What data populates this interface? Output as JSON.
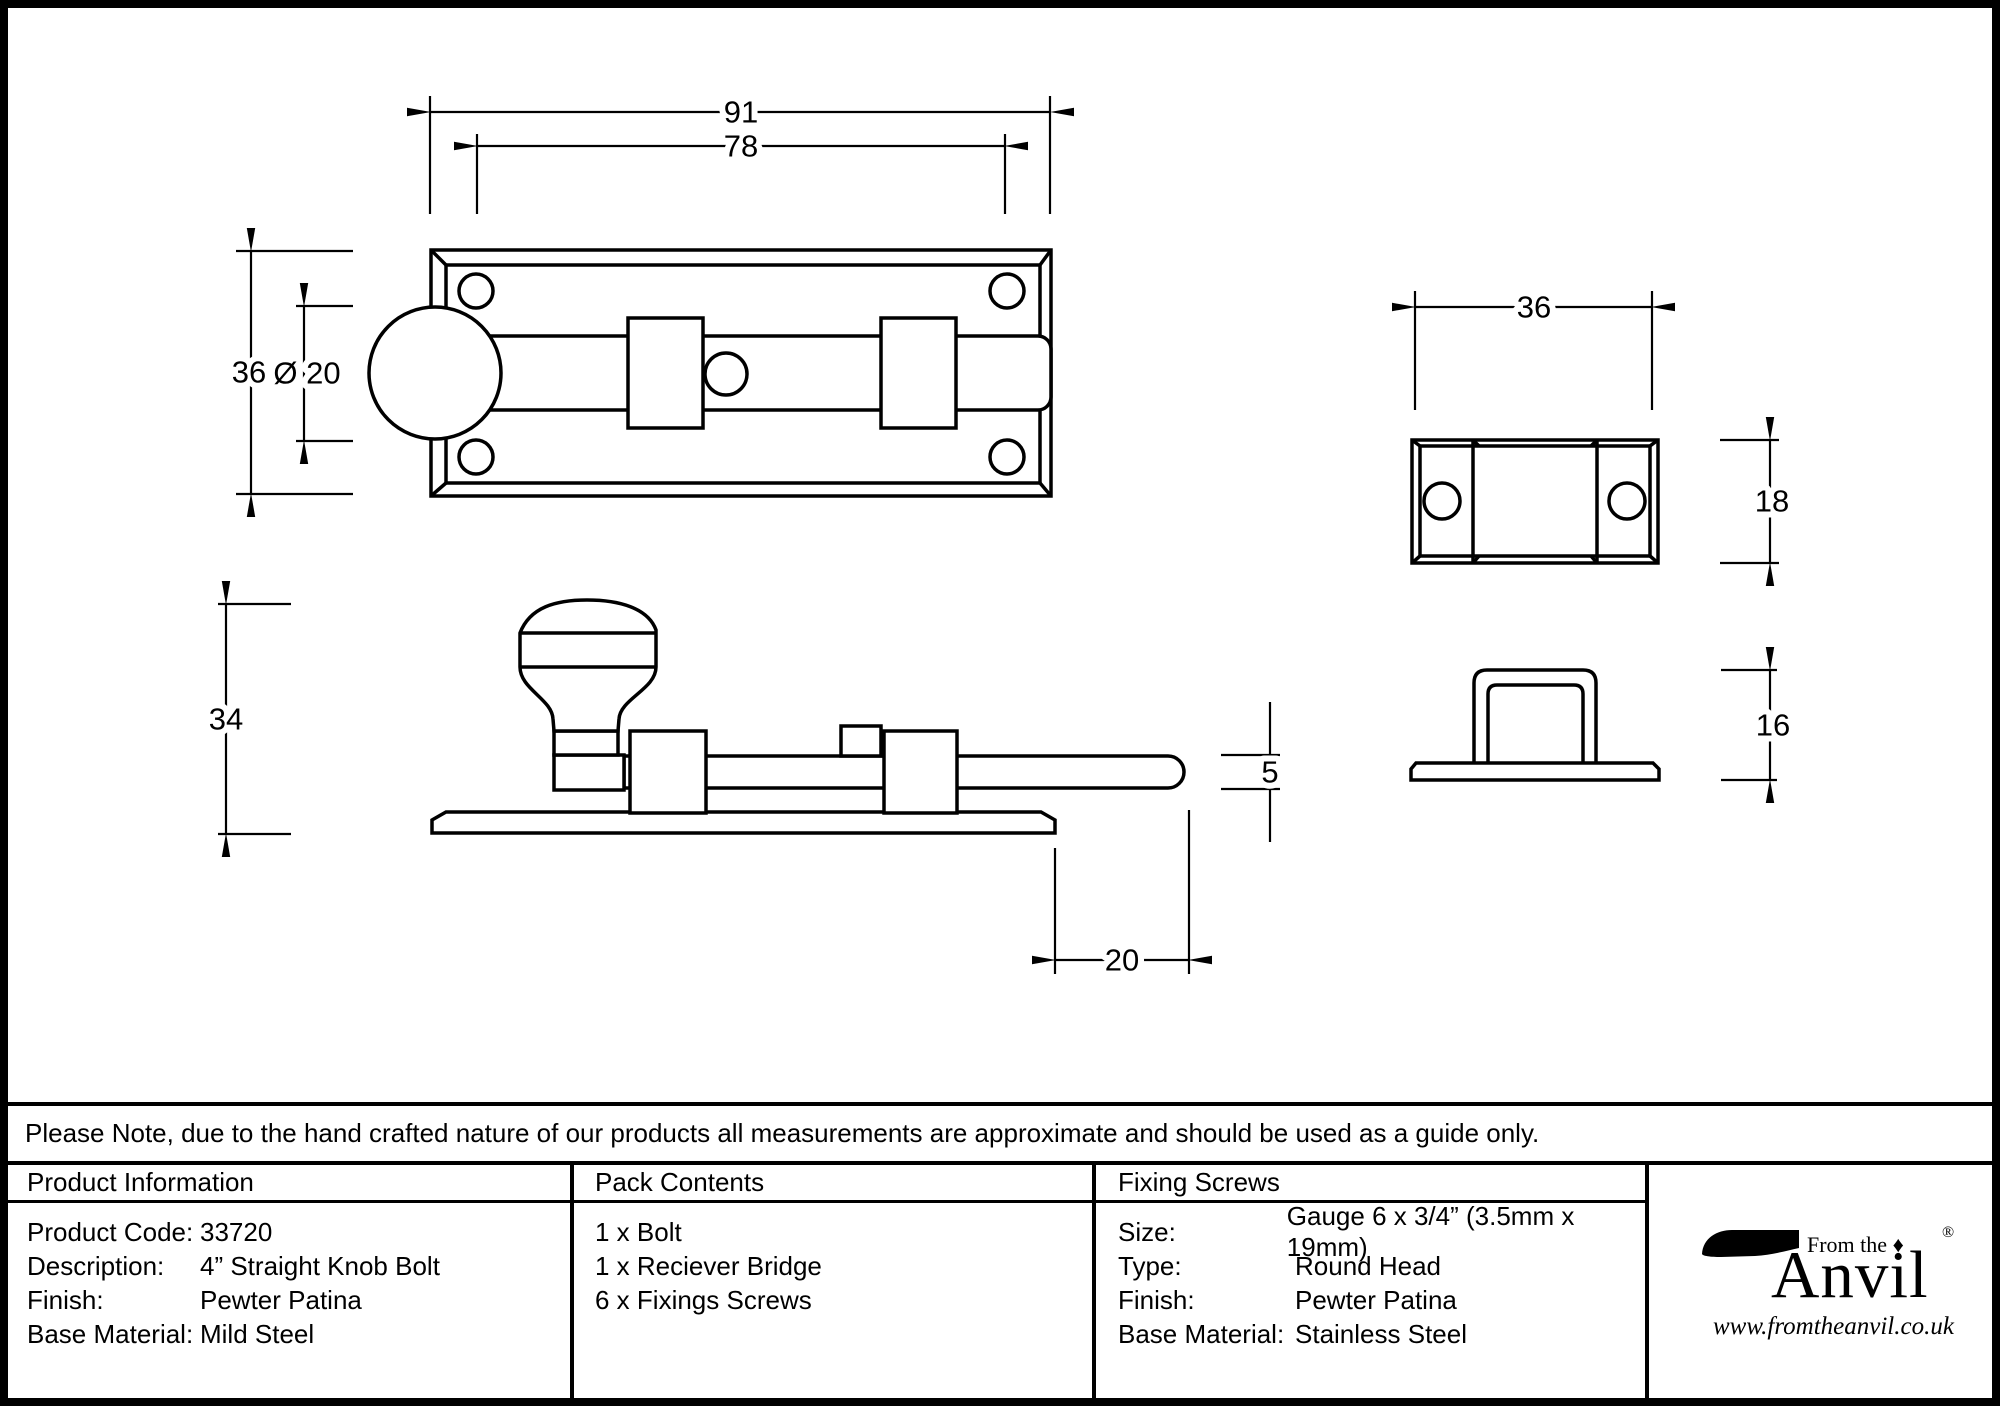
{
  "note": "Please Note, due to the hand crafted nature of our products all measurements are approximate and should be used as a guide only.",
  "drawing": {
    "front_view": {
      "overall_width": "91",
      "hole_spacing": "78",
      "plate_height": "36",
      "knob_diameter": "Ø 20"
    },
    "side_view": {
      "overall_height": "34",
      "bolt_thickness": "5",
      "bolt_throw": "20"
    },
    "receiver_front": {
      "width": "36",
      "height": "18"
    },
    "receiver_side": {
      "height": "16"
    }
  },
  "table": {
    "product_info": {
      "header": "Product Information",
      "rows": [
        {
          "label": "Product Code:",
          "value": "33720"
        },
        {
          "label": "Description:",
          "value": "4” Straight Knob Bolt"
        },
        {
          "label": "Finish:",
          "value": "Pewter Patina"
        },
        {
          "label": "Base Material:",
          "value": "Mild Steel"
        }
      ]
    },
    "pack_contents": {
      "header": "Pack Contents",
      "items": [
        "1 x Bolt",
        "1 x Reciever Bridge",
        "6 x Fixings Screws"
      ]
    },
    "fixing_screws": {
      "header": "Fixing Screws",
      "rows": [
        {
          "label": "Size:",
          "value": "Gauge 6 x 3/4” (3.5mm x 19mm)"
        },
        {
          "label": "Type:",
          "value": "Round Head"
        },
        {
          "label": "Finish:",
          "value": "Pewter Patina"
        },
        {
          "label": "Base Material:",
          "value": "Stainless Steel"
        }
      ]
    }
  },
  "logo": {
    "tagline": "From the",
    "diamond": "♦",
    "name": "Anvil",
    "registered": "®",
    "url": "www.fromtheanvil.co.uk"
  }
}
